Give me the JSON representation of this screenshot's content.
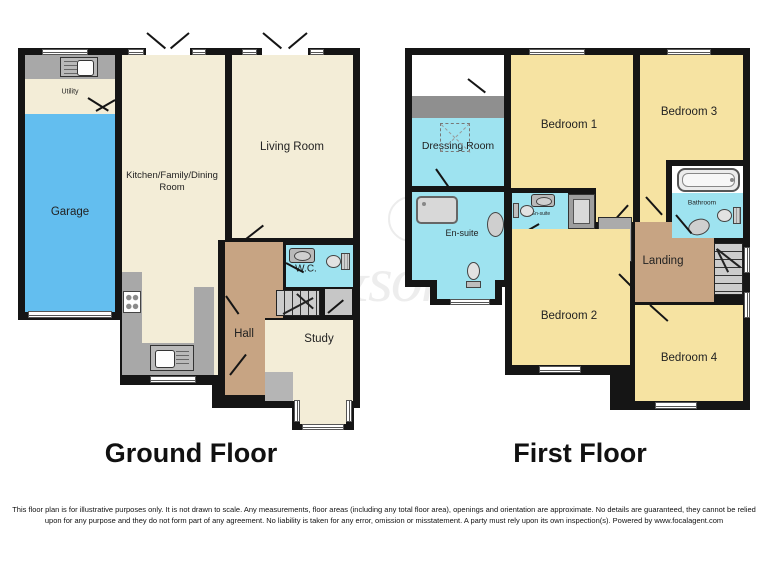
{
  "ground_floor": {
    "title": "Ground Floor",
    "rooms": {
      "utility": {
        "label": "Utility"
      },
      "garage": {
        "label": "Garage"
      },
      "kitchen": {
        "label": "Kitchen/Family/Dining Room"
      },
      "living_room": {
        "label": "Living Room"
      },
      "wc": {
        "label": "W.C."
      },
      "hall": {
        "label": "Hall"
      },
      "study": {
        "label": "Study"
      }
    }
  },
  "first_floor": {
    "title": "First Floor",
    "rooms": {
      "dressing_room": {
        "label": "Dressing Room"
      },
      "ensuite_main": {
        "label": "En-suite"
      },
      "ensuite_small": {
        "label": "En-suite"
      },
      "bedroom_1": {
        "label": "Bedroom 1"
      },
      "bedroom_2": {
        "label": "Bedroom 2"
      },
      "bedroom_3": {
        "label": "Bedroom 3"
      },
      "bedroom_4": {
        "label": "Bedroom 4"
      },
      "bathroom": {
        "label": "Bathroom"
      },
      "landing": {
        "label": "Landing"
      },
      "ac": {
        "label": "A/C"
      }
    }
  },
  "watermark": {
    "text": "fox&sons"
  },
  "disclaimer": "This floor plan is for illustrative purposes only. It is not drawn to scale. Any measurements, floor areas (including any total floor area), openings and orientation are approximate. No details are guaranteed, they cannot be relied upon for any purpose and they do not form part of any agreement. No liability is taken for any error, omission or misstatement. A party must rely upon its own inspection(s). Powered by www.focalagent.com",
  "colors": {
    "wall": "#151515",
    "room_cream": "#F3EDD7",
    "bedroom_yellow": "#F6E3A2",
    "garage_blue": "#63BEEF",
    "bathroom_blue": "#9EE3F0",
    "hall_brown": "#C7A483",
    "counter_gray": "#A8A8A8"
  }
}
